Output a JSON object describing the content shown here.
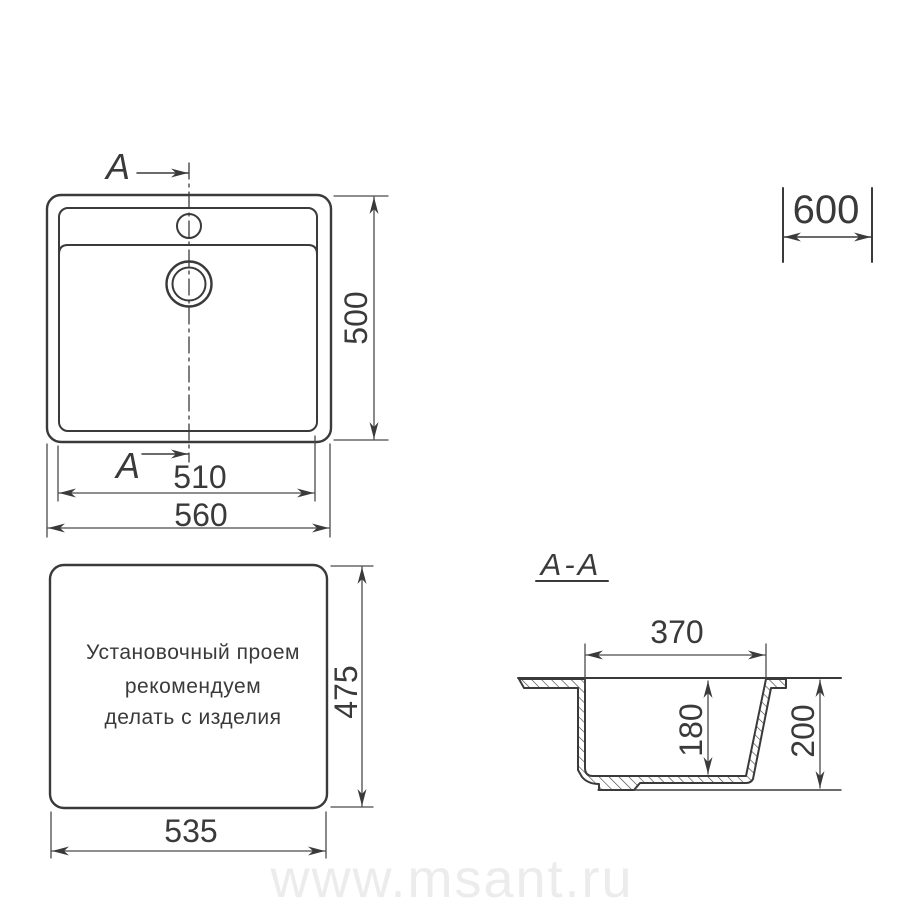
{
  "top_view": {
    "section_label_top": "A",
    "section_label_bottom": "A",
    "dim_height": "500",
    "dim_inner_width": "510",
    "dim_outer_width": "560"
  },
  "cabinet": {
    "dim_min_base_width": "600"
  },
  "cutout_view": {
    "note_line1": "Установочный проем",
    "note_line2": "рекомендуем",
    "note_line3": "делать с изделия",
    "dim_height": "475",
    "dim_width": "535"
  },
  "section_view": {
    "label": "A-A",
    "dim_bowl_top_width": "370",
    "dim_bowl_depth": "180",
    "dim_total_depth": "200"
  },
  "watermark": "www.msant.ru",
  "colors": {
    "object_line": "#3a3a3a",
    "dimension_line": "#4a4a4a",
    "watermark": "#ececec",
    "background": "#ffffff"
  }
}
